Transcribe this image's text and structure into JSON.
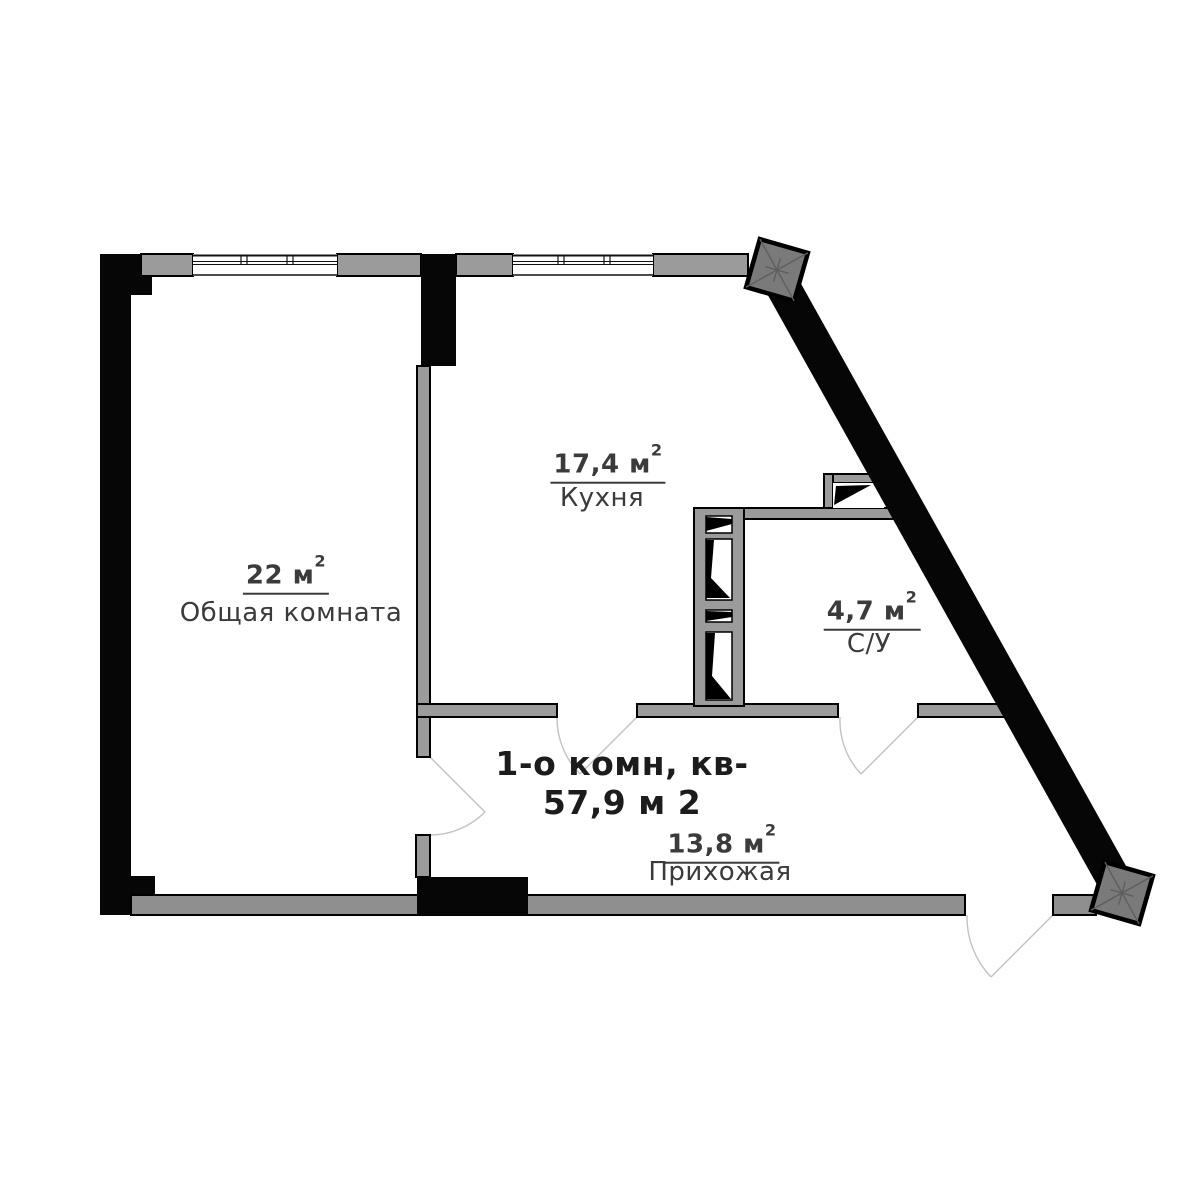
{
  "plan": {
    "title": {
      "line1": "1-о комн, кв-",
      "line2": "57,9 м 2"
    },
    "rooms": [
      {
        "id": "living",
        "area": "22 м",
        "area_sup": "2",
        "name": "Общая комната"
      },
      {
        "id": "kitchen",
        "area": "17,4 м",
        "area_sup": "2",
        "name": "Кухня"
      },
      {
        "id": "bath",
        "area": "4,7 м",
        "area_sup": "2",
        "name": "С/У"
      },
      {
        "id": "hall",
        "area": "13,8 м",
        "area_sup": "2",
        "name": "Прихожая"
      }
    ]
  },
  "colors": {
    "wall_black": "#060606",
    "wall_gray": "#9b9b9b",
    "band_gray": "#8f8f8f",
    "corner_gray": "#7a7a7a",
    "corner_line": "#5e5e5e",
    "arc_gray": "#c2c2c2",
    "label_text": "#3b3b3b",
    "title_text": "#1c1c1c"
  }
}
